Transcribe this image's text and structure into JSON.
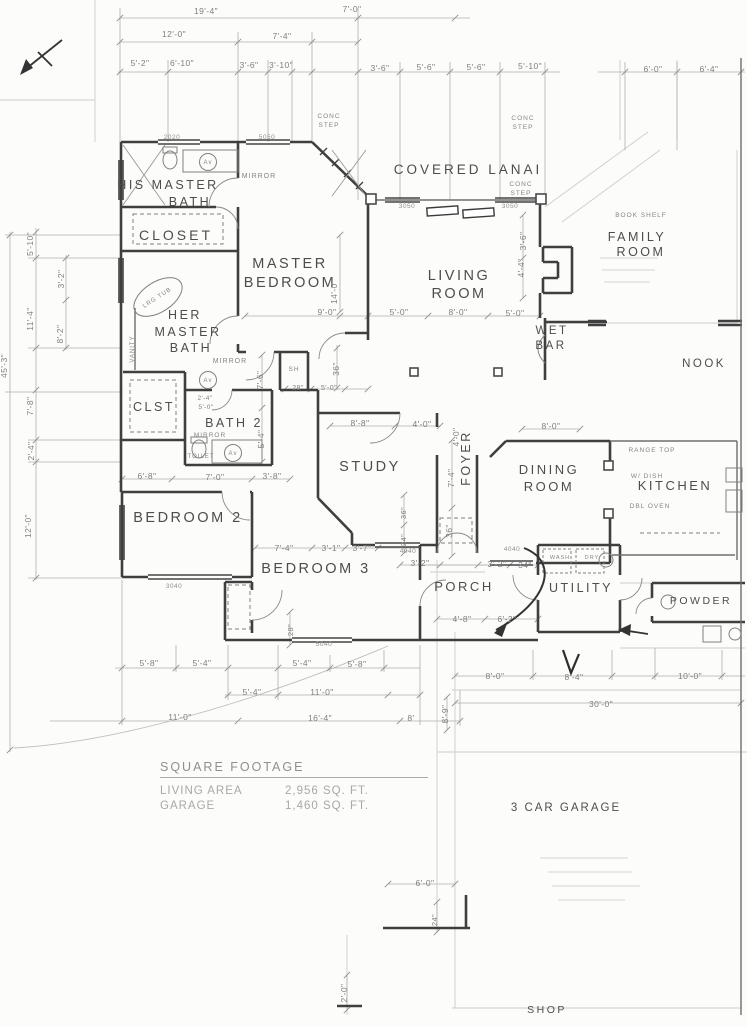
{
  "square_footage": {
    "heading": "SQUARE FOOTAGE",
    "rows": [
      {
        "label": "LIVING AREA",
        "value": "2,956 SQ. FT."
      },
      {
        "label": "GARAGE",
        "value": "1,460 SQ. FT."
      }
    ]
  },
  "labels": {
    "rooms": [
      {
        "n": "his-master-bath-line1",
        "t": "HIS MASTER",
        "x": 168,
        "y": 189,
        "s": 12.5
      },
      {
        "n": "his-master-bath-line2",
        "t": "BATH",
        "x": 190,
        "y": 206,
        "s": 12.5
      },
      {
        "n": "closet",
        "t": "CLOSET",
        "x": 176,
        "y": 240,
        "s": 14,
        "ls": 3
      },
      {
        "n": "master-bedroom-line1",
        "t": "MASTER",
        "x": 290,
        "y": 268,
        "s": 14.5
      },
      {
        "n": "master-bedroom-line2",
        "t": "BEDROOM",
        "x": 290,
        "y": 287,
        "s": 14.5
      },
      {
        "n": "covered-lanai",
        "t": "COVERED  LANAI",
        "x": 468,
        "y": 174,
        "s": 13.5,
        "ls": 3
      },
      {
        "n": "living-room-line1",
        "t": "LIVING",
        "x": 459,
        "y": 280,
        "s": 14.5
      },
      {
        "n": "living-room-line2",
        "t": "ROOM",
        "x": 459,
        "y": 298,
        "s": 14.5
      },
      {
        "n": "family-room-line1",
        "t": "FAMILY",
        "x": 637,
        "y": 241,
        "s": 12.5,
        "c": "#9b9b9b"
      },
      {
        "n": "family-room-line2",
        "t": "ROOM",
        "x": 641,
        "y": 256,
        "s": 12.5,
        "c": "#9b9b9b"
      },
      {
        "n": "nook",
        "t": "NOOK",
        "x": 704,
        "y": 367,
        "s": 11.5,
        "c": "#a3a3a3"
      },
      {
        "n": "wet-bar-line1",
        "t": "WET",
        "x": 552,
        "y": 334,
        "s": 11.5
      },
      {
        "n": "wet-bar-line2",
        "t": "BAR",
        "x": 551,
        "y": 349,
        "s": 11.5
      },
      {
        "n": "her-master-bath-line1",
        "t": "HER",
        "x": 185,
        "y": 319,
        "s": 12.5
      },
      {
        "n": "her-master-bath-line2",
        "t": "MASTER",
        "x": 188,
        "y": 336,
        "s": 12.5
      },
      {
        "n": "her-master-bath-line3",
        "t": "BATH",
        "x": 191,
        "y": 352,
        "s": 12.5
      },
      {
        "n": "clst",
        "t": "CLST",
        "x": 154,
        "y": 411,
        "s": 12.5
      },
      {
        "n": "bath-2",
        "t": "BATH 2",
        "x": 234,
        "y": 427,
        "s": 12.5
      },
      {
        "n": "study",
        "t": "STUDY",
        "x": 370,
        "y": 471,
        "s": 14.5
      },
      {
        "n": "foyer",
        "t": "FOYER",
        "x": 470,
        "y": 458,
        "s": 12.5,
        "r": -90
      },
      {
        "n": "dining-room-line1",
        "t": "DINING",
        "x": 549,
        "y": 474,
        "s": 13
      },
      {
        "n": "dining-room-line2",
        "t": "ROOM",
        "x": 549,
        "y": 491,
        "s": 13
      },
      {
        "n": "kitchen",
        "t": "KITCHEN",
        "x": 675,
        "y": 490,
        "s": 13,
        "c": "#8a8a8a"
      },
      {
        "n": "bedroom-2",
        "t": "BEDROOM 2",
        "x": 188,
        "y": 522,
        "s": 14.5
      },
      {
        "n": "bedroom-3",
        "t": "BEDROOM 3",
        "x": 316,
        "y": 573,
        "s": 14.5
      },
      {
        "n": "porch",
        "t": "PORCH",
        "x": 464,
        "y": 591,
        "s": 13
      },
      {
        "n": "utility",
        "t": "UTILITY",
        "x": 581,
        "y": 592,
        "s": 12.5
      },
      {
        "n": "powder",
        "t": "POWDER",
        "x": 701,
        "y": 604,
        "s": 10.5
      },
      {
        "n": "three-car-garage",
        "t": "3 CAR GARAGE",
        "x": 566,
        "y": 811,
        "s": 11.5,
        "c": "#aaaaaa",
        "ls": 2
      },
      {
        "n": "shop",
        "t": "SHOP",
        "x": 547,
        "y": 1013,
        "s": 10.5,
        "c": "#a8a8a8"
      }
    ],
    "annotations": [
      {
        "n": "mirror-his-bath",
        "t": "MIRROR",
        "x": 259,
        "y": 178
      },
      {
        "n": "mirror-her-bath",
        "t": "MIRROR",
        "x": 230,
        "y": 363
      },
      {
        "n": "mirror-bath2",
        "t": "MIRROR",
        "x": 210,
        "y": 437,
        "s": 6.5
      },
      {
        "n": "toilet-label",
        "t": "TOILET",
        "x": 201,
        "y": 458,
        "s": 6,
        "c": "#999999"
      },
      {
        "n": "conc-step-1a",
        "t": "CONC",
        "x": 329,
        "y": 118,
        "s": 6.5
      },
      {
        "n": "conc-step-1b",
        "t": "STEP",
        "x": 329,
        "y": 127,
        "s": 6.5
      },
      {
        "n": "conc-step-2a",
        "t": "CONC",
        "x": 523,
        "y": 120,
        "s": 6.5,
        "c": "#9d9d9d"
      },
      {
        "n": "conc-step-2b",
        "t": "STEP",
        "x": 523,
        "y": 129,
        "s": 6.5,
        "c": "#9d9d9d"
      },
      {
        "n": "conc-step-3a",
        "t": "CONC",
        "x": 521,
        "y": 186,
        "s": 6.5,
        "c": "#9d9d9d"
      },
      {
        "n": "conc-step-3b",
        "t": "STEP",
        "x": 521,
        "y": 195,
        "s": 6.5,
        "c": "#9d9d9d"
      },
      {
        "n": "book-shelf",
        "t": "BOOK SHELF",
        "x": 641,
        "y": 217,
        "s": 6.5,
        "c": "#b0b0b0"
      },
      {
        "n": "range-top",
        "t": "RANGE TOP",
        "x": 652,
        "y": 452,
        "s": 6.5,
        "c": "#adadad"
      },
      {
        "n": "w-dish",
        "t": "W/ DISH",
        "x": 647,
        "y": 478,
        "s": 6.5,
        "c": "#b5b5b5"
      },
      {
        "n": "dbl-oven",
        "t": "DBL OVEN",
        "x": 650,
        "y": 508,
        "s": 6.5,
        "c": "#b5b5b5"
      },
      {
        "n": "wash",
        "t": "WASH",
        "x": 560,
        "y": 559,
        "s": 5.5,
        "c": "#a9a9a9"
      },
      {
        "n": "dry",
        "t": "DRY",
        "x": 592,
        "y": 559,
        "s": 5.5,
        "c": "#b3b3b3"
      },
      {
        "n": "lrg-tub",
        "t": "LRG TUB",
        "x": 158,
        "y": 299,
        "s": 6,
        "r": -33
      },
      {
        "n": "vanity",
        "t": "VANITY",
        "x": 134,
        "y": 349,
        "s": 6,
        "r": -90
      },
      {
        "n": "shower-sh",
        "t": "SH",
        "x": 294,
        "y": 371,
        "s": 6.5
      },
      {
        "n": "lav-1",
        "t": "Av",
        "x": 208,
        "y": 164,
        "s": 6
      },
      {
        "n": "lav-2",
        "t": "Av",
        "x": 208,
        "y": 382,
        "s": 6
      },
      {
        "n": "lav-3",
        "t": "Av",
        "x": 233,
        "y": 455,
        "s": 6
      }
    ],
    "window_codes": [
      {
        "n": "win-2020",
        "t": "2020",
        "x": 172,
        "y": 139
      },
      {
        "n": "win-5050",
        "t": "5050",
        "x": 267,
        "y": 139
      },
      {
        "n": "win-3050-a",
        "t": "3050",
        "x": 407,
        "y": 208
      },
      {
        "n": "win-3050-b",
        "t": "3050",
        "x": 510,
        "y": 208
      },
      {
        "n": "win-4040-a",
        "t": "4040",
        "x": 408,
        "y": 553
      },
      {
        "n": "win-4040-b",
        "t": "4040",
        "x": 512,
        "y": 551
      },
      {
        "n": "win-3040",
        "t": "3040",
        "x": 174,
        "y": 588
      },
      {
        "n": "win-5040",
        "t": "5040",
        "x": 324,
        "y": 646
      }
    ],
    "dimensions": [
      {
        "t": "19'-4\"",
        "x": 206,
        "y": 14
      },
      {
        "t": "7'-0\"",
        "x": 352,
        "y": 12
      },
      {
        "t": "12'-0\"",
        "x": 174,
        "y": 37
      },
      {
        "t": "7'-4\"",
        "x": 282,
        "y": 39
      },
      {
        "t": "5'-2\"",
        "x": 140,
        "y": 66
      },
      {
        "t": "6'-10\"",
        "x": 182,
        "y": 66
      },
      {
        "t": "3'-6\"",
        "x": 249,
        "y": 68
      },
      {
        "t": "3'-10\"",
        "x": 281,
        "y": 68
      },
      {
        "t": "3'-6\"",
        "x": 380,
        "y": 71
      },
      {
        "t": "5'-6\"",
        "x": 426,
        "y": 70
      },
      {
        "t": "5'-6\"",
        "x": 476,
        "y": 70
      },
      {
        "t": "5'-10\"",
        "x": 530,
        "y": 69
      },
      {
        "t": "6'-0\"",
        "x": 653,
        "y": 72
      },
      {
        "t": "6'-4\"",
        "x": 709,
        "y": 72
      },
      {
        "t": "5'-10\"",
        "x": 33,
        "y": 244,
        "r": -90
      },
      {
        "t": "3'-2\"",
        "x": 64,
        "y": 279,
        "r": -90
      },
      {
        "t": "11'-4\"",
        "x": 33,
        "y": 319,
        "r": -90
      },
      {
        "t": "8'-2\"",
        "x": 63,
        "y": 334,
        "r": -90
      },
      {
        "t": "45'-3\"",
        "x": 7,
        "y": 366,
        "r": -90
      },
      {
        "t": "7'-8\"",
        "x": 33,
        "y": 406,
        "r": -90
      },
      {
        "t": "2'-4\"",
        "x": 34,
        "y": 451,
        "r": -90
      },
      {
        "t": "12'-0\"",
        "x": 31,
        "y": 526,
        "r": -90
      },
      {
        "t": "14'-0\"",
        "x": 337,
        "y": 292,
        "r": -90
      },
      {
        "t": "9'-0\"",
        "x": 327,
        "y": 315
      },
      {
        "t": "5'-0\"",
        "x": 399,
        "y": 315
      },
      {
        "t": "36\"",
        "x": 339,
        "y": 369,
        "r": -90
      },
      {
        "t": "28\"",
        "x": 298,
        "y": 390,
        "s": 7
      },
      {
        "t": "5'-0\"",
        "x": 329,
        "y": 390,
        "s": 7
      },
      {
        "t": "8'-0\"",
        "x": 458,
        "y": 315
      },
      {
        "t": "5'-0\"",
        "x": 515,
        "y": 316
      },
      {
        "t": "3'-6\"",
        "x": 526,
        "y": 241,
        "r": -90
      },
      {
        "t": "4'-4\"",
        "x": 524,
        "y": 268,
        "r": -90
      },
      {
        "t": "7'-6\"",
        "x": 263,
        "y": 380,
        "r": -90
      },
      {
        "t": "5'-4\"",
        "x": 264,
        "y": 439,
        "r": -90
      },
      {
        "t": "2'-4\"",
        "x": 205,
        "y": 400,
        "s": 6.5
      },
      {
        "t": "5'-0\"",
        "x": 206,
        "y": 409,
        "s": 6.5
      },
      {
        "t": "8'-8\"",
        "x": 360,
        "y": 426
      },
      {
        "t": "4'-0\"",
        "x": 422,
        "y": 427
      },
      {
        "t": "4'-0\"",
        "x": 459,
        "y": 437,
        "r": -90
      },
      {
        "t": "7'-4\"",
        "x": 454,
        "y": 478,
        "r": -90
      },
      {
        "t": "36\"",
        "x": 452,
        "y": 531,
        "r": -90
      },
      {
        "t": "36\"",
        "x": 406,
        "y": 513,
        "r": -90,
        "s": 7.5
      },
      {
        "t": "24\"",
        "x": 406,
        "y": 540,
        "r": -90,
        "s": 7.5
      },
      {
        "t": "6'-8\"",
        "x": 147,
        "y": 479
      },
      {
        "t": "7'-0\"",
        "x": 215,
        "y": 480
      },
      {
        "t": "3'-8\"",
        "x": 272,
        "y": 479
      },
      {
        "t": "7'-4\"",
        "x": 284,
        "y": 551
      },
      {
        "t": "3'-1\"",
        "x": 331,
        "y": 551
      },
      {
        "t": "3'-7\"",
        "x": 362,
        "y": 551
      },
      {
        "t": "28\"",
        "x": 293,
        "y": 630,
        "r": -90,
        "s": 7.5
      },
      {
        "t": "3'-2\"",
        "x": 420,
        "y": 566
      },
      {
        "t": "3'-2\"",
        "x": 497,
        "y": 567
      },
      {
        "t": "34\"",
        "x": 525,
        "y": 568
      },
      {
        "t": "4'-8\"",
        "x": 462,
        "y": 622
      },
      {
        "t": "6'-2\"",
        "x": 507,
        "y": 622
      },
      {
        "t": "8'-0\"",
        "x": 551,
        "y": 429
      },
      {
        "t": "8'-0\"",
        "x": 495,
        "y": 679
      },
      {
        "t": "8'-4\"",
        "x": 574,
        "y": 680
      },
      {
        "t": "10'-0\"",
        "x": 690,
        "y": 679,
        "c": "#b0b0b0"
      },
      {
        "t": "30'-0\"",
        "x": 601,
        "y": 707,
        "c": "#b0b0b0"
      },
      {
        "t": "5'-8\"",
        "x": 149,
        "y": 666
      },
      {
        "t": "5'-4\"",
        "x": 202,
        "y": 666
      },
      {
        "t": "5'-4\"",
        "x": 302,
        "y": 666,
        "c": "#a5a5a5"
      },
      {
        "t": "5'-8\"",
        "x": 357,
        "y": 667
      },
      {
        "t": "5'-4\"",
        "x": 252,
        "y": 695
      },
      {
        "t": "11'-0\"",
        "x": 322,
        "y": 695
      },
      {
        "t": "11'-0\"",
        "x": 180,
        "y": 720
      },
      {
        "t": "16'-4\"",
        "x": 320,
        "y": 721
      },
      {
        "t": "8'",
        "x": 411,
        "y": 721
      },
      {
        "t": "8'-9\"",
        "x": 448,
        "y": 714,
        "r": -90
      },
      {
        "t": "6'-0\"",
        "x": 425,
        "y": 886
      },
      {
        "t": "24\"",
        "x": 437,
        "y": 920,
        "r": -90,
        "s": 7.5
      },
      {
        "t": "2'-0\"",
        "x": 347,
        "y": 993,
        "r": -90
      }
    ]
  }
}
